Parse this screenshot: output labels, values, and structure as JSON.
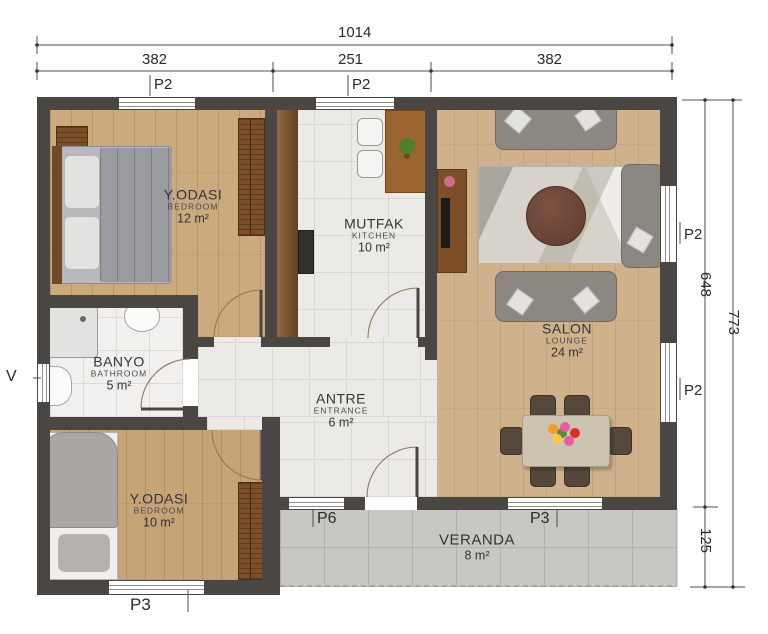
{
  "dimensions": {
    "total_width": "1014",
    "seg_left": "382",
    "seg_mid": "251",
    "seg_right": "382",
    "inner_height": "648",
    "total_height": "773",
    "veranda_height": "125"
  },
  "openings": {
    "window_top_bedroom": "P2",
    "window_top_kitchen": "P2",
    "window_right_upper": "P2",
    "window_right_lower": "P2",
    "window_bathroom": "V",
    "window_bedroom2": "P3",
    "door_entrance": "P6",
    "window_salon_veranda": "P3"
  },
  "rooms": {
    "bedroom1": {
      "name": "Y.ODASI",
      "type": "BEDROOM",
      "area": "12 m²"
    },
    "kitchen": {
      "name": "MUTFAK",
      "type": "KITCHEN",
      "area": "10 m²"
    },
    "salon": {
      "name": "SALON",
      "type": "LOUNGE",
      "area": "24 m²"
    },
    "bathroom": {
      "name": "BANYO",
      "type": "BATHROOM",
      "area": "5 m²"
    },
    "antre": {
      "name": "ANTRE",
      "type": "ENTRANCE",
      "area": "6 m²"
    },
    "bedroom2": {
      "name": "Y.ODASI",
      "type": "BEDROOM",
      "area": "10 m²"
    },
    "veranda": {
      "name": "VERANDA",
      "area": "8 m²"
    }
  },
  "colors": {
    "wall": "#4a4644",
    "wood_floor": "#cbaa80",
    "tile_floor": "#eceae7",
    "veranda_floor": "#c9c7c3",
    "cabinet_brown": "#8a5a2d",
    "sofa_gray": "#8d8781",
    "text": "#2e2e2e"
  }
}
